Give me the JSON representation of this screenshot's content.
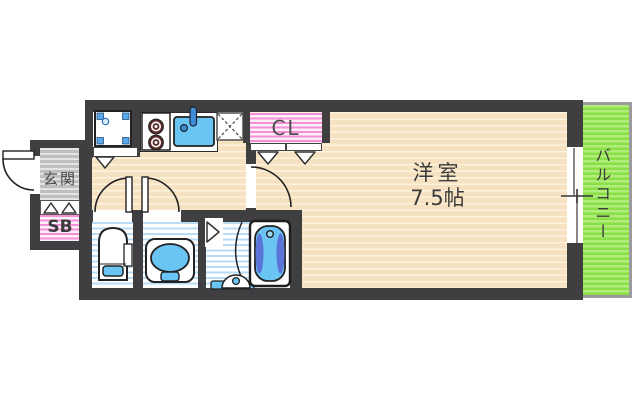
{
  "plan": {
    "rooms": {
      "main_room": {
        "name": "洋室",
        "size": "7.5帖"
      },
      "balcony": {
        "label": "バルコニー"
      },
      "entrance": {
        "label": "玄関"
      },
      "shoe_box": {
        "label": "SB"
      },
      "closet": {
        "label": "CL"
      }
    },
    "icons": {
      "washing_machine_pan": "square with blue corner pads and drain dot",
      "gas_stove": "two dark burner rings",
      "kitchen_sink": "blue basin with faucet",
      "refrigerator_space": "dashed X square",
      "toilet": "top-view toilet with blue step",
      "washbasin": "vanity with blue oval basin",
      "bathtub": "top-view tub with dark side cushions",
      "bath_faucet": "dome faucet with drain dot on blue ledge",
      "sliding_window": "sash with center cross mark",
      "folding_door": "triangle markers",
      "door_swing": "quarter-circle arc"
    },
    "colors": {
      "wall": "#3f3f41",
      "floor_base": "#f6e2c0",
      "floor_stripe": "#fdf2de",
      "genkan_base": "#bfbfbf",
      "genkan_stripe": "#e4e4e4",
      "pink_bg": "#fdeffa",
      "pink_line": "#f58fd7",
      "bath_line": "#b9dcf6",
      "balcony_base": "#8bdf46",
      "balcony_stripe": "#b0ed7c",
      "fixture_blue": "#6ac4f4",
      "fixture_blue_dark": "#5b74d8",
      "faucet_blue": "#3f8fd8",
      "pad_blue": "#57a9e9",
      "burner": "#5d2b29",
      "text": "#3b3b3b"
    }
  }
}
